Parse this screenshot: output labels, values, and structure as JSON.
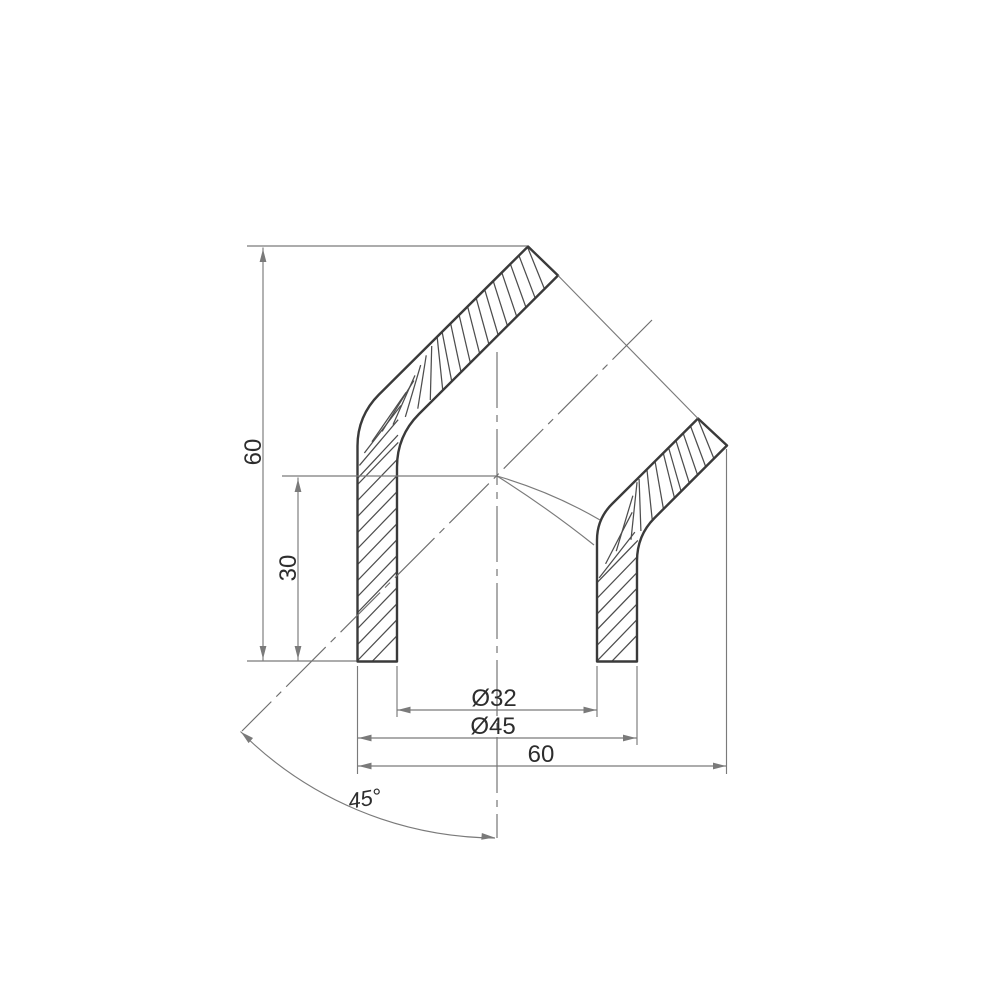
{
  "drawing": {
    "kind": "technical-dimension-drawing",
    "labels": {
      "height_total": "60",
      "height_socket": "30",
      "diameter_inner": "Ø32",
      "diameter_outer": "Ø45",
      "width_total": "60",
      "bend_angle": "45°"
    },
    "colors": {
      "background": "#ffffff",
      "outline": "#3a3a3a",
      "hatch": "#4d4d4d",
      "thin_line": "#7a7a7a",
      "centerline": "#6e6e6e",
      "text": "#2d2d2d"
    }
  }
}
